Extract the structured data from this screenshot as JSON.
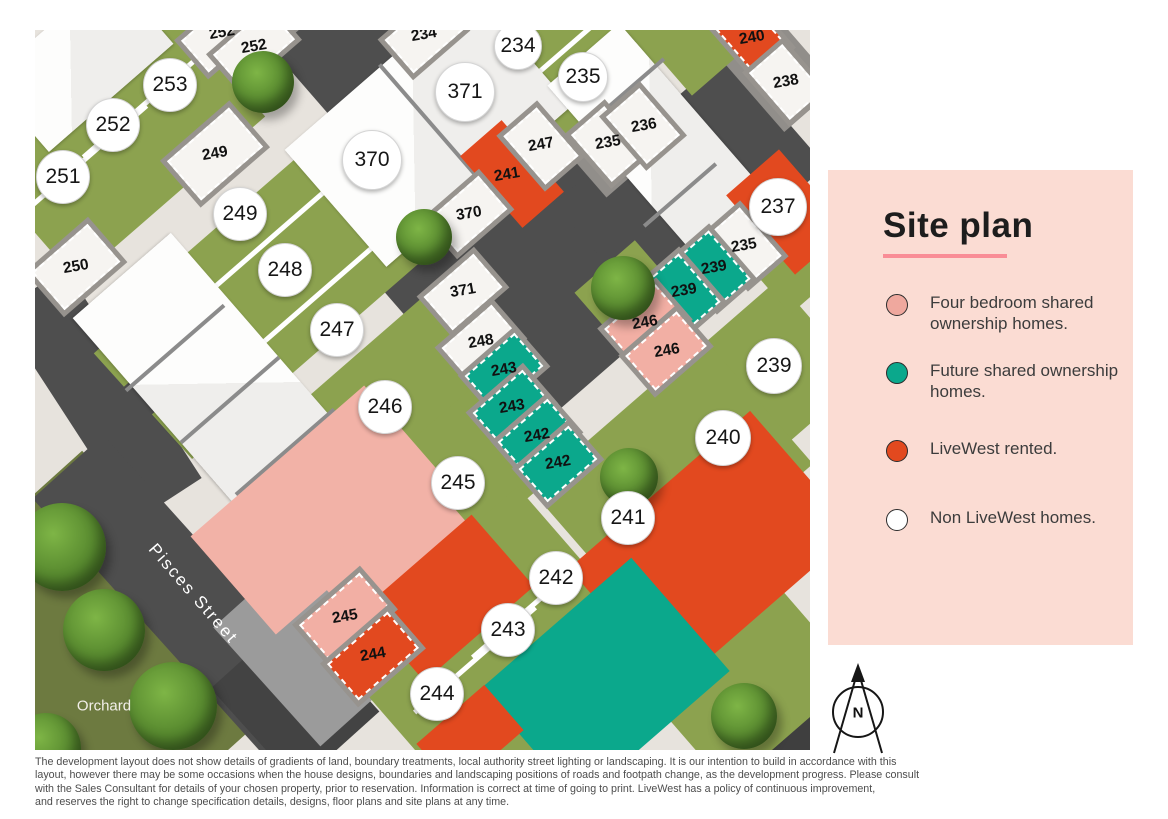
{
  "legend": {
    "title": "Site plan",
    "items": [
      {
        "label": "Four bedroom shared ownership homes.",
        "color": "#efa89e"
      },
      {
        "label": "Future shared ownership homes.",
        "color": "#0ba88c"
      },
      {
        "label": "LiveWest rented.",
        "color": "#e2491f"
      },
      {
        "label": "Non LiveWest homes.",
        "color": "#ffffff"
      }
    ]
  },
  "map": {
    "street_label": "Pisces Street",
    "area_label": "Orchard",
    "plot_circles": [
      {
        "label": "253"
      },
      {
        "label": "252"
      },
      {
        "label": "251"
      },
      {
        "label": "249"
      },
      {
        "label": "248"
      },
      {
        "label": "247"
      },
      {
        "label": "246"
      },
      {
        "label": "245"
      },
      {
        "label": "244"
      },
      {
        "label": "243"
      },
      {
        "label": "242"
      },
      {
        "label": "241"
      },
      {
        "label": "240"
      },
      {
        "label": "239"
      },
      {
        "label": "237"
      },
      {
        "label": "235"
      },
      {
        "label": "234"
      },
      {
        "label": "371"
      },
      {
        "label": "370"
      }
    ],
    "parking_labels": [
      {
        "label": "252"
      },
      {
        "label": "252"
      },
      {
        "label": "234"
      },
      {
        "label": "249"
      },
      {
        "label": "250"
      },
      {
        "label": "247"
      },
      {
        "label": "241"
      },
      {
        "label": "370"
      },
      {
        "label": "371"
      },
      {
        "label": "248"
      },
      {
        "label": "243"
      },
      {
        "label": "243"
      },
      {
        "label": "242"
      },
      {
        "label": "242"
      },
      {
        "label": "236"
      },
      {
        "label": "235"
      },
      {
        "label": "240"
      },
      {
        "label": "238"
      },
      {
        "label": "235"
      },
      {
        "label": "239"
      },
      {
        "label": "239"
      },
      {
        "label": "246"
      },
      {
        "label": "246"
      },
      {
        "label": "245"
      },
      {
        "label": "244"
      }
    ]
  },
  "compass": {
    "label": "N"
  },
  "footer": {
    "lines": [
      "The development layout does not show details of gradients of land, boundary treatments, local authority street lighting or landscaping. It is our intention to build in accordance with this",
      "layout, however there may be some occasions when the house designs, boundaries and landscaping positions of roads and footpath change, as the development progress. Please consult",
      "with the Sales Consultant for details of your chosen property, prior to reservation. Information is correct at time of going to print. LiveWest has a policy of continuous improvement,",
      "and reserves the right to change specification details, designs, floor plans and site plans at any time."
    ]
  },
  "colors": {
    "grass": "#8ca24f",
    "road": "#4e4e4e",
    "path": "#e7e3dd",
    "four_bed_shared": "#efa89e",
    "future_shared": "#0ba88c",
    "livewest_rented": "#e2491f",
    "non_livewest": "#ffffff",
    "legend_background": "#fbdcd3",
    "title_underline": "#f98d96"
  }
}
